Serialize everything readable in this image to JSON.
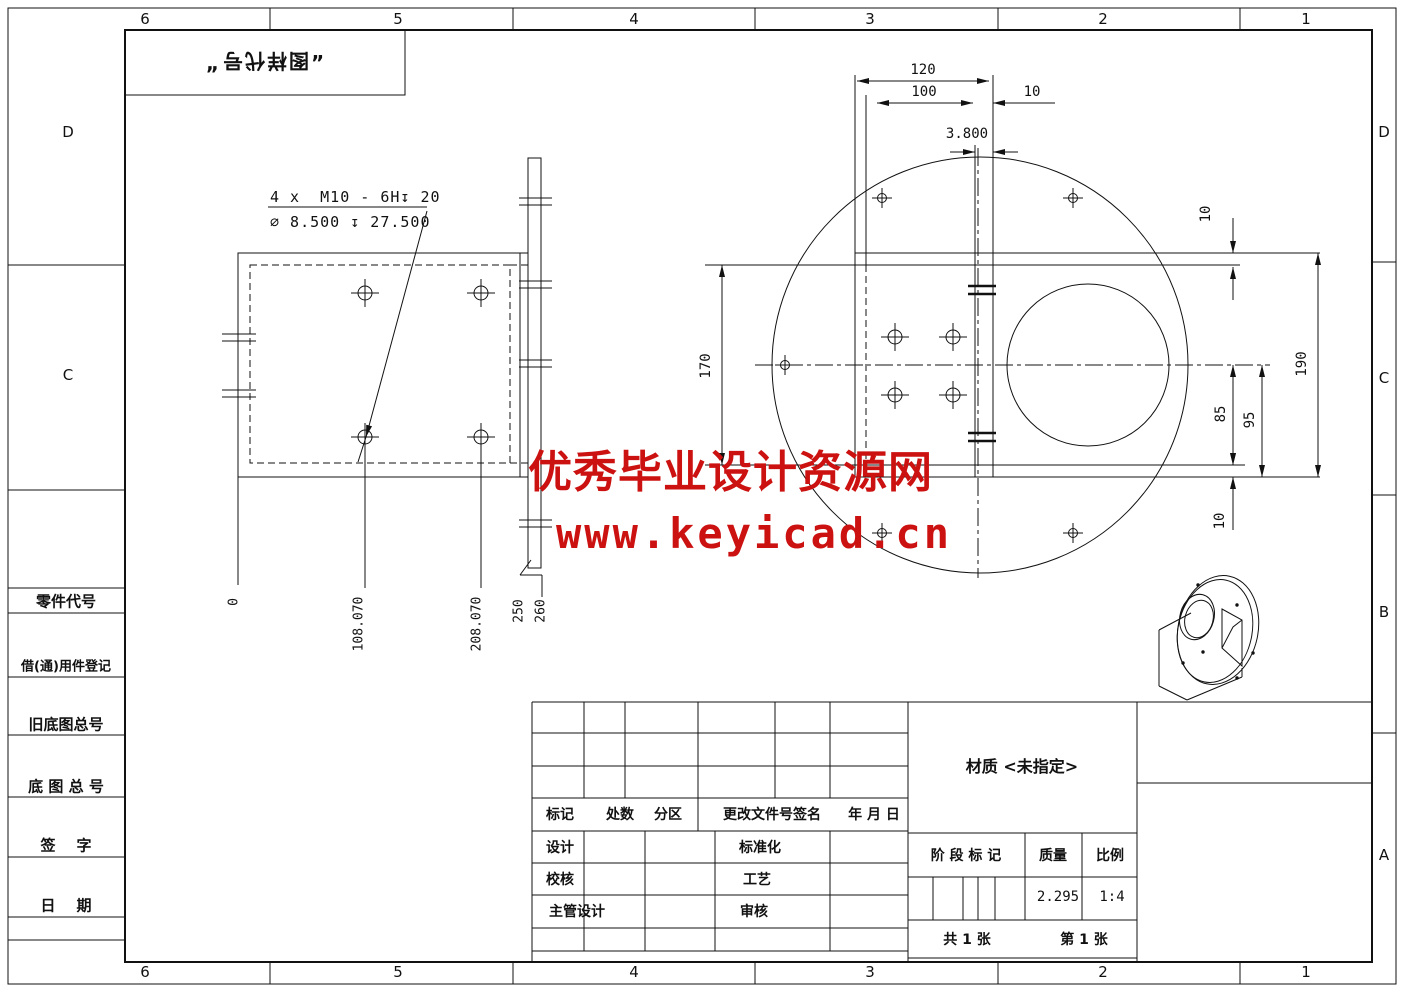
{
  "border": {
    "cols": [
      "6",
      "5",
      "4",
      "3",
      "2",
      "1"
    ],
    "rows_left": [
      "D",
      "C"
    ],
    "rows_right": [
      "D",
      "C",
      "B",
      "A"
    ]
  },
  "stamp": {
    "quote_open": "„",
    "text": "图样代号",
    "quote_close": "”"
  },
  "watermark": {
    "line1": "优秀毕业设计资源网",
    "line2": "www.keyicad.cn",
    "color": "#cc1111"
  },
  "plan_view": {
    "note1": "4 x  M10 - 6H↧ 20",
    "note2": "⌀ 8.500 ↧ 27.500",
    "ords": [
      "0",
      "108.070",
      "208.070",
      "250",
      "260"
    ]
  },
  "front_view": {
    "d120": "120",
    "d100": "100",
    "d10_top": "10",
    "d38": "3.800",
    "d170": "170",
    "d10_r1": "10",
    "d85": "85",
    "d95": "95",
    "d190": "190",
    "d10_r2": "10"
  },
  "sidebar": {
    "labels": [
      "零件代号",
      "借(通)用件登记",
      "旧底图总号",
      "底 图 总 号",
      "签    字",
      "日    期"
    ]
  },
  "title_block": {
    "header": [
      "标记",
      "处数",
      "分区",
      "更改文件号签名",
      "年 月 日"
    ],
    "sign_labels": [
      "设计",
      "标准化",
      "校核",
      "工艺",
      "主管设计",
      "审核"
    ],
    "material": "材质 <未指定>",
    "stage": "阶 段 标 记",
    "mass_label": "质量",
    "scale_label": "比例",
    "mass": "2.295",
    "scale": "1:4",
    "sheets_total": "共 1 张",
    "sheet_no": "第 1 张"
  }
}
